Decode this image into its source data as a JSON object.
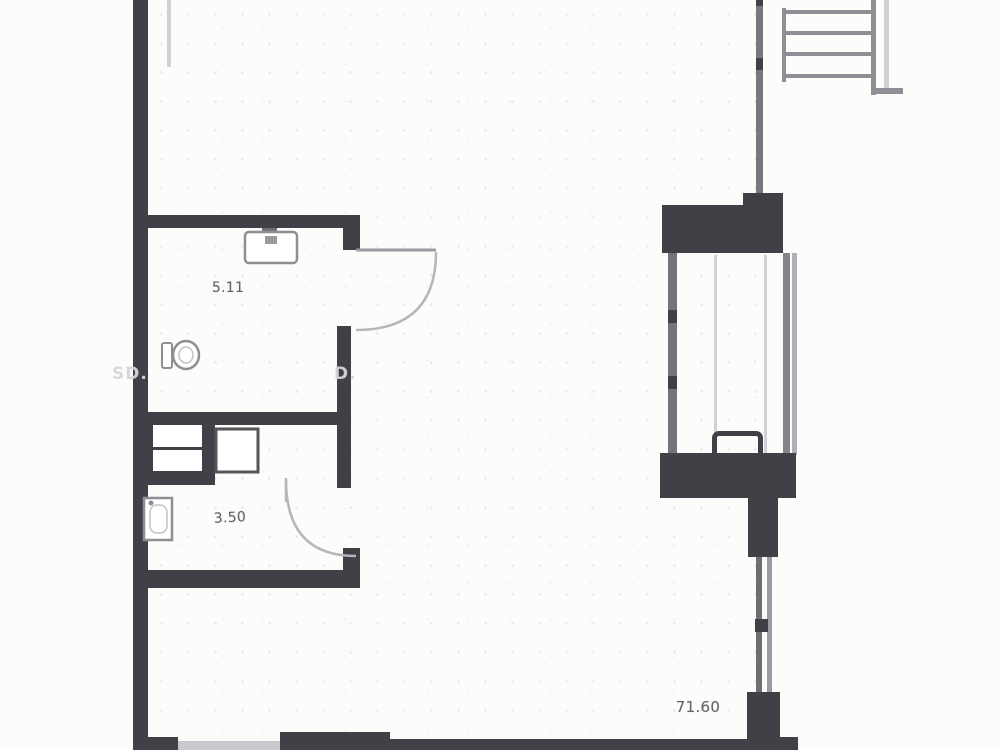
{
  "labels": {
    "bathroom_area": "5.11",
    "wc_area": "3.50",
    "living_area": "71.60"
  },
  "watermarks": {
    "left": "SD.",
    "middle": "D."
  },
  "icons": {
    "sink": "sink-icon",
    "toilet": "toilet-icon",
    "water-heater": "water-heater-icon",
    "shower-box": "shower-box-icon"
  },
  "colors": {
    "wall": "#404046",
    "line": "#8e8e94",
    "line-mid": "#77777d",
    "faint": "#d2d2d6",
    "label": "#63636a",
    "watermark": "#d6d6d9",
    "bg": "#fcfcfb"
  }
}
